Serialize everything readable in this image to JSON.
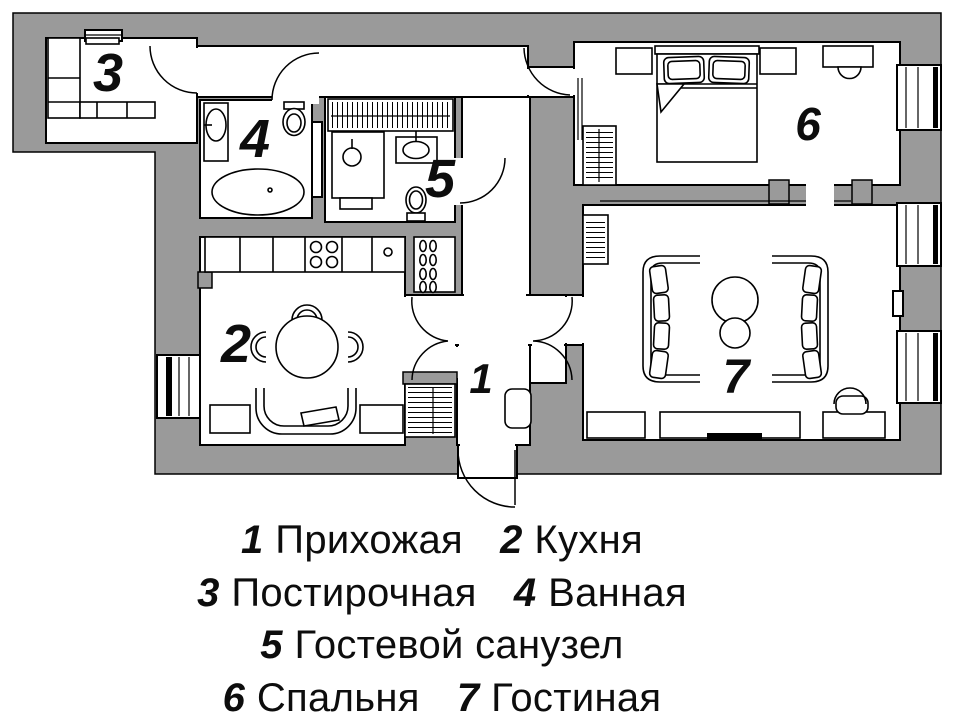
{
  "plan": {
    "rooms": [
      {
        "number": "1",
        "name": "Прихожая"
      },
      {
        "number": "2",
        "name": "Кухня"
      },
      {
        "number": "3",
        "name": "Постирочная"
      },
      {
        "number": "4",
        "name": "Ванная"
      },
      {
        "number": "5",
        "name": "Гостевой санузел"
      },
      {
        "number": "6",
        "name": "Спальня"
      },
      {
        "number": "7",
        "name": "Гостиная"
      }
    ]
  },
  "legend": {
    "rows": [
      {
        "items": [
          {
            "num": "1",
            "label": "Прихожая"
          },
          {
            "num": "2",
            "label": "Кухня"
          }
        ]
      },
      {
        "items": [
          {
            "num": "3",
            "label": "Постирочная"
          },
          {
            "num": "4",
            "label": "Ванная"
          }
        ]
      },
      {
        "items": [
          {
            "num": "5",
            "label": "Гостевой санузел"
          }
        ]
      },
      {
        "items": [
          {
            "num": "6",
            "label": "Спальня"
          },
          {
            "num": "7",
            "label": "Гостиная"
          }
        ]
      }
    ]
  },
  "colors": {
    "wall": "#9a9a9a",
    "line": "#000000",
    "floor": "#ffffff"
  }
}
